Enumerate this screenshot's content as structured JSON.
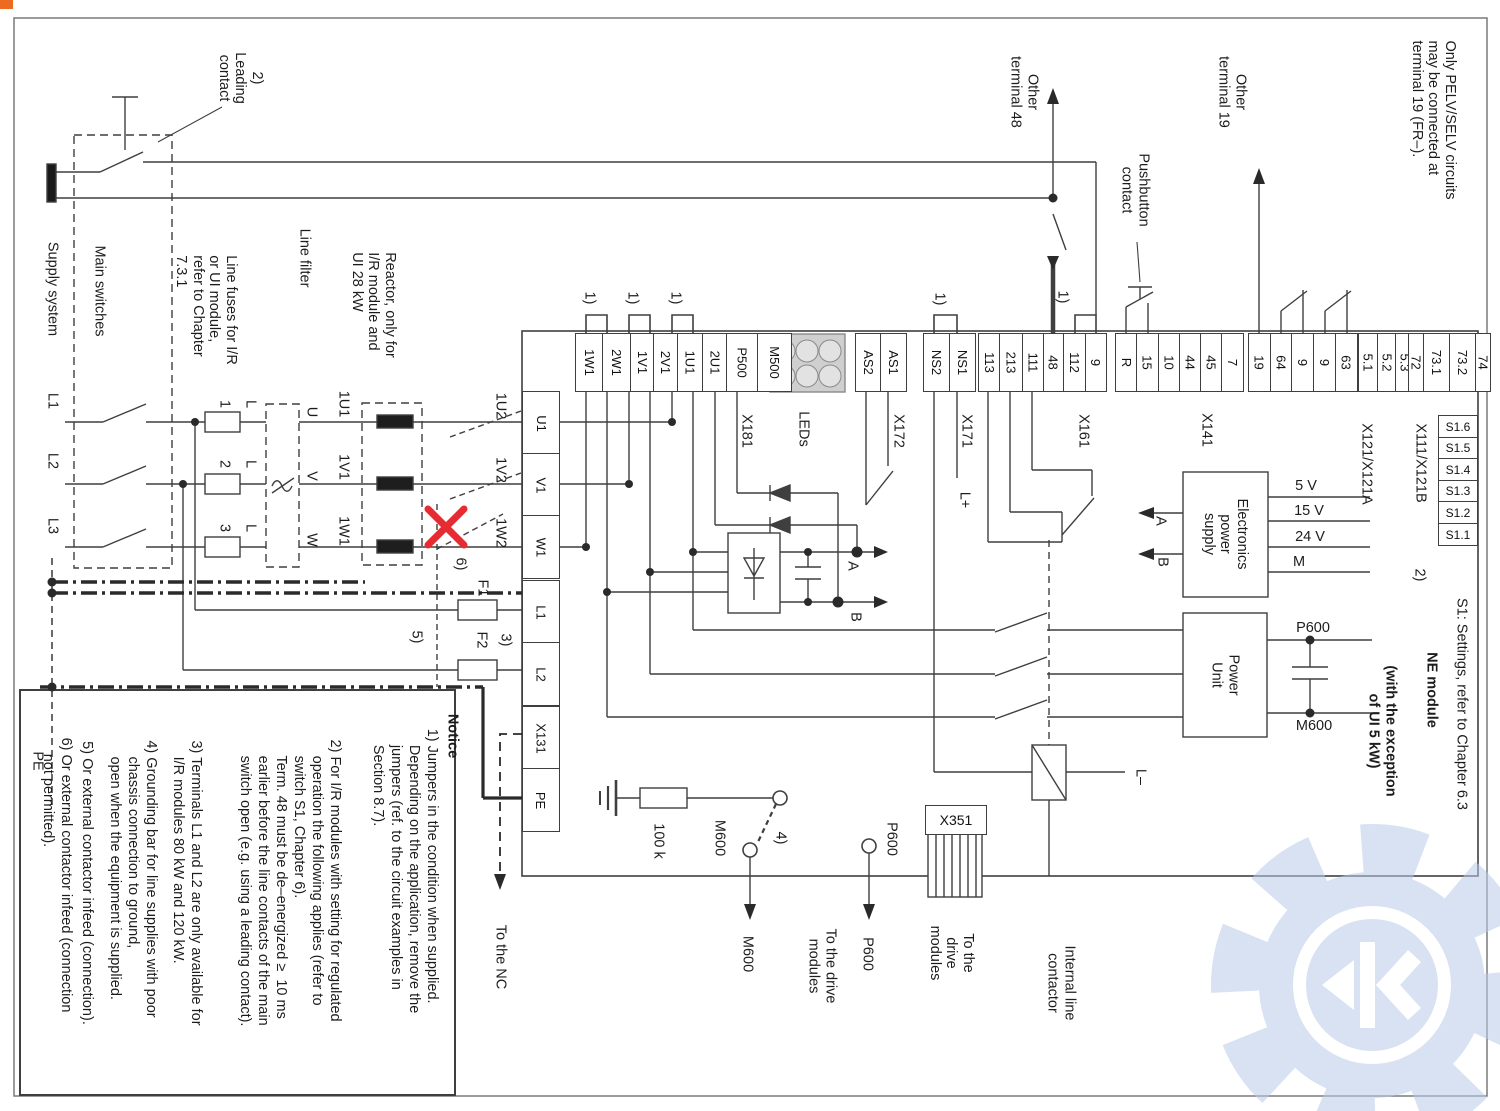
{
  "labels": {
    "leading_contact": "2)\nLeading\ncontact",
    "supply_system": "Supply system",
    "main_switches": "Main switches",
    "line_fuses": "Line fuses for I/R\nor UI module,\nrefer to Chapter\n7.3.1",
    "line_filter": "Line filter",
    "reactor": "Reactor, only for\nI/R module and\nUI 28 kW",
    "l1": "L1",
    "l2": "L2",
    "l3": "L3",
    "pe": "PE",
    "fuse1": "1",
    "fuse2": "2",
    "fuse3": "3",
    "fl1": "L",
    "fl2": "L",
    "fl3": "L",
    "u": "U",
    "v": "V",
    "w": "W",
    "r1u1": "1U1",
    "r1v1": "1V1",
    "r1w1": "1W1",
    "t1u2": "1U2",
    "t1v2": "1V2",
    "t1w2": "1W2",
    "n6": "6)",
    "f1": "F1",
    "n5": "5)",
    "f2": "F2",
    "n3": "3)",
    "jumper": "1)",
    "other_terminal_48": "Other\nterminal 48",
    "pushbutton_contact": "Pushbutton\ncontact",
    "other_terminal_19": "Other\nterminal 19",
    "pelv": "Only PELV/SELV circuits\nmay be connected at\nterminal 19 (FR–).",
    "x181": "X181",
    "leds": "LEDs",
    "x172": "X172",
    "x171": "X171",
    "x161": "X161",
    "x141": "X141",
    "x121": "X121/X121A",
    "x111": "X111/X121B",
    "lplus": "L+",
    "lminus": "L–",
    "a_out": "A",
    "b_out": "B",
    "a_in": "A",
    "b_in": "B",
    "eps": "Electronics\npower\nsupply",
    "power_unit": "Power\nUnit",
    "s1_settings": "S1: Settings, refer to Chapter 6.3",
    "s1_note": "2)",
    "ne_module": "NE module",
    "ne_exception": "(with the exception\nof UI 5 kW)",
    "v5": "5 V",
    "v15": "15 V",
    "v24": "24 V",
    "m_out": "M",
    "p600": "P600",
    "m600": "M600",
    "x351": "X351",
    "res100k": "100 k",
    "m600_tap": "M600",
    "p600_tap": "P600",
    "n4": "4)",
    "m600_arrow": "M600",
    "p600_arrow": "P600",
    "to_drive_1": "To the drive\nmodules",
    "to_drive_2": "To the\ndrive\nmodules",
    "internal_contactor": "Internal line\ncontactor",
    "to_nc": "To the NC"
  },
  "terminals": {
    "x181": [
      "1W1",
      "2W1",
      "1V1",
      "2V1",
      "1U1",
      "2U1",
      "P500",
      "M500"
    ],
    "x172": [
      "AS2",
      "AS1"
    ],
    "x171": [
      "NS2",
      "NS1"
    ],
    "x161": [
      "113",
      "213",
      "111",
      "48",
      "112",
      "9"
    ],
    "x141": [
      "R",
      "15",
      "10",
      "44",
      "45",
      "7"
    ],
    "x121": [
      "19",
      "64",
      "9",
      "9",
      "63"
    ],
    "x121n": [
      "5.1",
      "5.2",
      "5.3"
    ],
    "x111": [
      "72",
      "73.1",
      "73.2",
      "74"
    ],
    "left": [
      "U1",
      "V1",
      "W1",
      "L1",
      "L2",
      "X131",
      "PE"
    ],
    "s1": [
      "S1.6",
      "S1.5",
      "S1.4",
      "S1.3",
      "S1.2",
      "S1.1"
    ]
  },
  "notes": {
    "heading": "Notice",
    "n1": "1) Jumpers in the condition when supplied.\n    Depending on the application, remove the\n    jumpers (ref. to the circuit examples in\n    Section 8.7).",
    "n2": "2) For I/R modules with setting for regulated\n    operation the following applies (refer to\n    switch S1, Chapter 6).\n    Term. 48 must be de–energized ≥  10 ms\n    earlier before the line contacts of the main\n    switch open (e.g. using a leading contact).",
    "n3": "3) Terminals L1 and L2 are only available for\n    I/R modules 80 kW and 120 kW.",
    "n4": "4) Grounding bar for line supplies with poor\n    chassis connection to ground,\n    open when the equipment is supplied.",
    "n5": "5) Or external contactor infeed (connection).",
    "n6": "6) Or external contactor infeed (connection\n    not permitted)."
  },
  "colors": {
    "wire": "#3f3f3f",
    "red_x": "#e62b32",
    "watermark": "#b9cbe8",
    "led_fill": "#e2e2e2",
    "corner_mark": "#ed6b21"
  }
}
